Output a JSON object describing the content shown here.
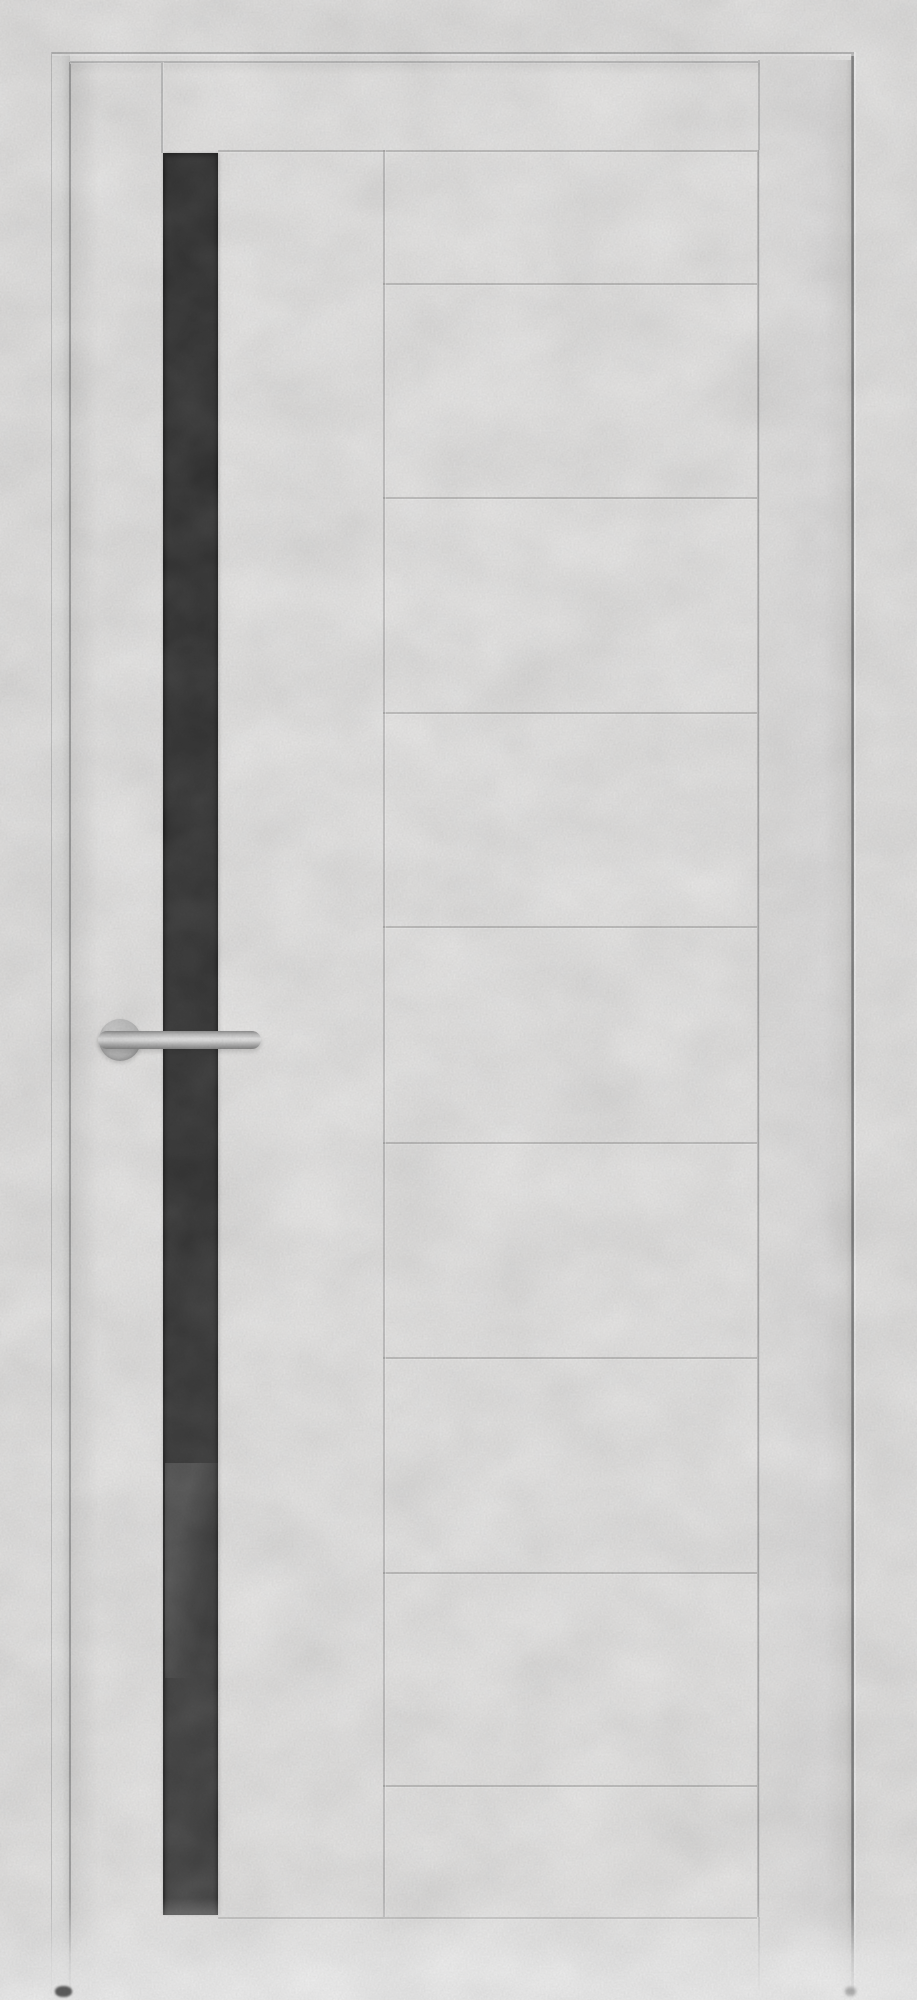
{
  "image": {
    "kind": "product photo",
    "subject": "Interior door in patina-white concrete finish with a tall black glass strip and a chrome lever handle, shown closed inside its frame on a plain light wall",
    "text_content": "none"
  },
  "palette": {
    "wall": "#f1f0ef",
    "leaf": "#f4f3f2",
    "groove_line": "#bfbfbf",
    "frame_line_dark": "#858585",
    "frame_line_light": "#c9c9c9",
    "glass_dark": "#2c2c2c",
    "glass_light": "#3e3e3e",
    "handle_metal": "#cfcfcf"
  },
  "geometry": {
    "canvas": {
      "w": 917,
      "h": 2000
    },
    "frame": {
      "outer_left_x": 52,
      "outer_top_y": 52,
      "outer_right_x": 851,
      "bottom_y": 1994,
      "left_jamb": {
        "x1": 52,
        "x2": 70
      },
      "right_jamb": {
        "x1": 760,
        "x2": 851
      }
    },
    "leaf": {
      "left": 71,
      "top": 62,
      "right": 760,
      "bottom": 1994
    },
    "stile_groove": {
      "x": 161,
      "top": 62,
      "bottom": 153
    },
    "glass": {
      "left": 163,
      "top": 153,
      "width": 55,
      "bottom": 1915,
      "sheen_top": 1463,
      "sheen_height": 215
    },
    "panel": {
      "left": 383,
      "right": 757,
      "horizontal_grooves": [
        150,
        283,
        497,
        712,
        926,
        1142,
        1357,
        1572,
        1785,
        1917
      ],
      "wide_rows": [
        150,
        1917
      ],
      "wide_span_left": 218
    },
    "handle": {
      "rose_cx": 120,
      "rose_cy": 1040,
      "rose_r": 21,
      "lever_left": 98,
      "lever_top": 1031,
      "lever_width": 163,
      "lever_height": 18
    },
    "floor_fade_top": 1898,
    "foot_left": {
      "x": 55,
      "y": 1986,
      "w": 17,
      "h": 11
    },
    "foot_right": {
      "x": 845,
      "y": 1987,
      "w": 11,
      "h": 9
    }
  }
}
